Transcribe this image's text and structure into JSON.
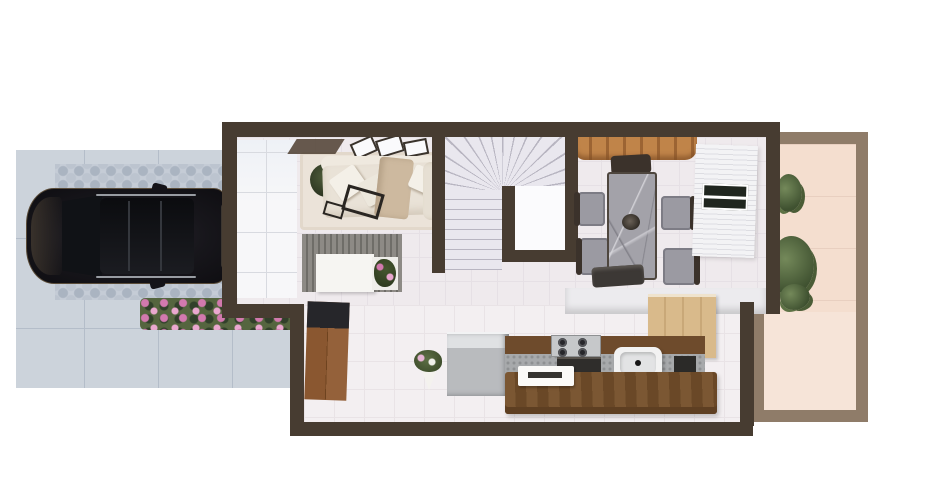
{
  "scene": {
    "description": "3D rendered top-down floor plan of a narrow house ground floor",
    "view": "top-down architectural render, no text labels visible",
    "canvas": {
      "width": 927,
      "height": 489
    }
  },
  "palette": {
    "wall": "#473c31",
    "patio_wall": "#8f7c69",
    "floor": "#efeaed",
    "floor_lower": "#f3eff1",
    "patio_floor": "#f4decf",
    "drive_tile": "#ccd3db",
    "drive_line": "#b4bdc9",
    "hex_dot": "#aab4c1",
    "flower_green": "#55653f",
    "flower_pink": "#d279ae",
    "car_body": "#17161b",
    "sofa": "#e9e2d7",
    "throw": "#cdb99f",
    "media": "#85827d",
    "console": "#f6f5f2",
    "wood": "#8a5730",
    "counter_wood": "#6e4b2c",
    "island": "#7b5733",
    "stainless": "#c6c8ca",
    "marble": "#a3a2a9",
    "chair_dark": "#3b322b",
    "chair_gray": "#9b9aa2",
    "beam": "#b5793f",
    "cabinet": "#d9ba8b",
    "door": "#f3f3f5",
    "glass": "#20261f",
    "stair_tread": "#e9e7ee",
    "stair_line": "#b8b5c1",
    "rug": "#ebe3d9",
    "white": "#fbfbfd",
    "dark_top": "#26262a"
  },
  "exterior": {
    "driveway": {
      "label": "Driveway with parked dark SUV",
      "items": [
        {
          "name": "paver-tiles",
          "desc": "large light gray tiles"
        },
        {
          "name": "hex-paver-strip-top",
          "desc": "hexagonal paver band"
        },
        {
          "name": "hex-paver-strip-bottom",
          "desc": "hexagonal paver band"
        },
        {
          "name": "parked-suv",
          "desc": "dark SUV, roof rails, sunroof, facing left"
        },
        {
          "name": "flower-bed",
          "desc": "pink flowers on green shrubs"
        }
      ]
    },
    "patio": {
      "label": "Back patio",
      "items": [
        {
          "name": "patio-plant-small"
        },
        {
          "name": "patio-plant-large"
        },
        {
          "name": "patio-plant-low"
        }
      ]
    }
  },
  "house": {
    "living_room": {
      "label": "Living room",
      "items": [
        {
          "name": "wardrobe-panels",
          "desc": "white paneled closet along left wall"
        },
        {
          "name": "wall-art-frames",
          "count": 3
        },
        {
          "name": "floor-plant"
        },
        {
          "name": "sectional-sofa",
          "desc": "cream L-sofa with cushions and tan throw"
        },
        {
          "name": "coffee-tables",
          "count": 2,
          "desc": "dark metal frame"
        },
        {
          "name": "media-slat-wall",
          "desc": "gray slatted TV partition"
        },
        {
          "name": "tv-console",
          "desc": "white console"
        },
        {
          "name": "console-planter",
          "desc": "pink flowers"
        },
        {
          "name": "area-rug"
        }
      ]
    },
    "staircase": {
      "label": "U-shaped staircase",
      "items": [
        {
          "name": "winder-treads",
          "desc": "fanned treads at top"
        },
        {
          "name": "straight-flight",
          "desc": "treads along left wall"
        },
        {
          "name": "stair-void",
          "desc": "white well wrapped by dark walls"
        }
      ]
    },
    "dining_room": {
      "label": "Dining room",
      "items": [
        {
          "name": "wood-beam-decor",
          "desc": "terracotta log beams at top wall"
        },
        {
          "name": "marble-dining-table",
          "desc": "gray marble top"
        },
        {
          "name": "dining-chairs",
          "count": 5,
          "desc": "dark wood with gray seats"
        },
        {
          "name": "table-centerpiece"
        },
        {
          "name": "sliding-glass-door",
          "desc": "white frame, dark glass, right wall"
        }
      ]
    },
    "kitchen": {
      "label": "Kitchen",
      "items": [
        {
          "name": "refrigerator",
          "desc": "stainless"
        },
        {
          "name": "counter",
          "desc": "wood top, concrete front"
        },
        {
          "name": "gas-cooktop",
          "burners": 4
        },
        {
          "name": "oven"
        },
        {
          "name": "range-hood"
        },
        {
          "name": "kitchen-sink",
          "desc": "white with black faucet"
        },
        {
          "name": "dishwasher"
        },
        {
          "name": "tall-cabinets",
          "desc": "light wood"
        },
        {
          "name": "half-wall",
          "desc": "white partition to dining"
        },
        {
          "name": "wood-island",
          "desc": "large butcher-block island"
        },
        {
          "name": "serving-tray",
          "desc": "white tray on island"
        }
      ]
    },
    "hallway": {
      "label": "Entry hallway",
      "items": [
        {
          "name": "wood-vanity-cabinet",
          "desc": "dark top, wood doors, left wall"
        },
        {
          "name": "floor-bouquet",
          "desc": "wrapped flowers on floor"
        }
      ]
    }
  }
}
